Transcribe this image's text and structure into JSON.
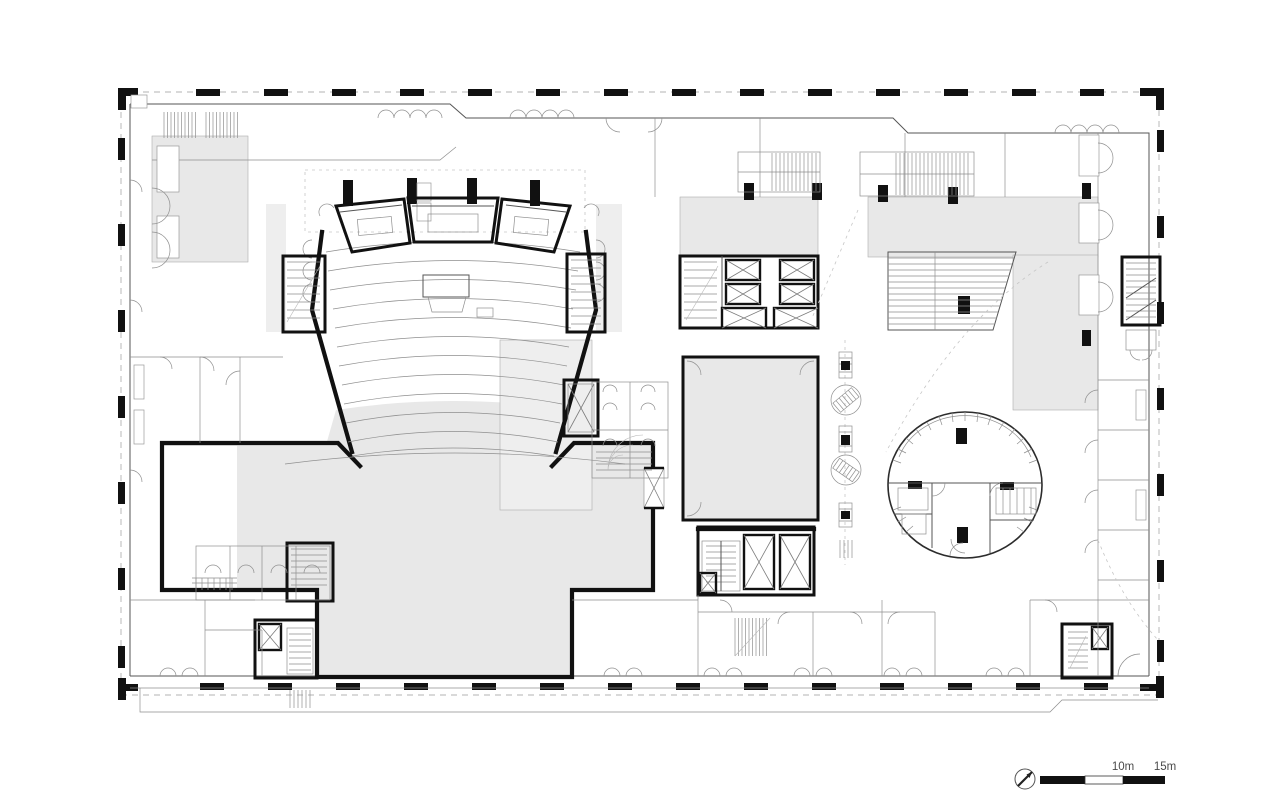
{
  "drawing": {
    "kind": "architectural floor plan",
    "scale_bar": {
      "labels": [
        "10m",
        "15m"
      ]
    },
    "north_arrow": {
      "icon": "north-arrow-icon"
    }
  },
  "colors": {
    "paper": "#ffffff",
    "wall": "#111111",
    "line_dark": "#3c3c3c",
    "line_light": "#8f8f8f",
    "zone_fill": "#e8e8e8",
    "zone_fill_light": "#eeeeee",
    "perimeter_dash": "#b3b3b3",
    "column_black": "#111111"
  }
}
